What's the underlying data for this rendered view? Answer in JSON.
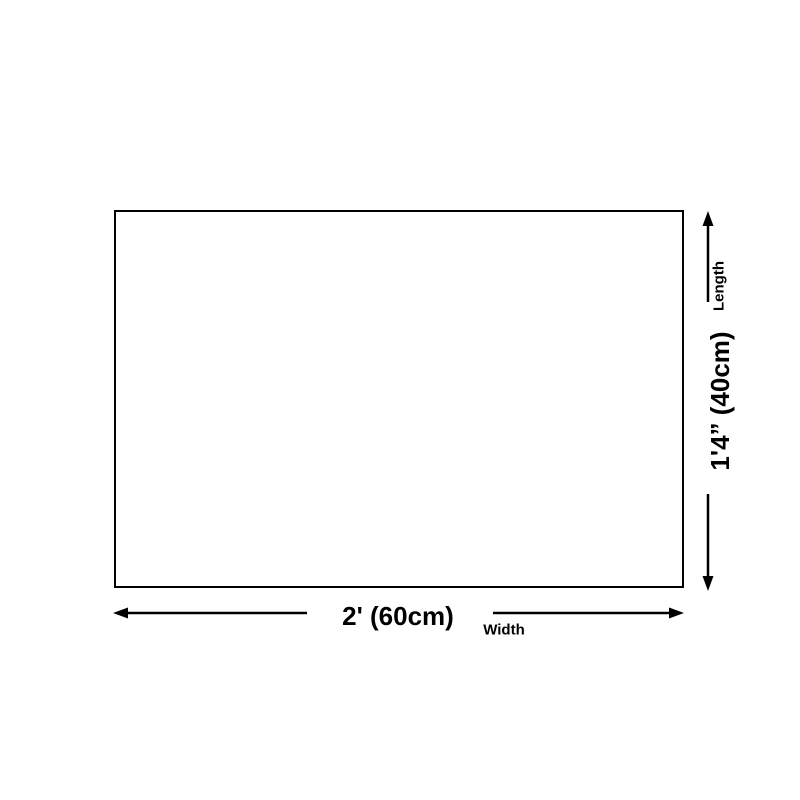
{
  "page": {
    "background_color": "#ffffff",
    "ink_color": "#000000"
  },
  "diagram": {
    "shape": "rectangle-outline",
    "width_dimension": {
      "value": "2' (60cm)",
      "axis_label": "Width"
    },
    "length_dimension": {
      "value": "1'4” (40cm)",
      "axis_label": "Length"
    }
  }
}
